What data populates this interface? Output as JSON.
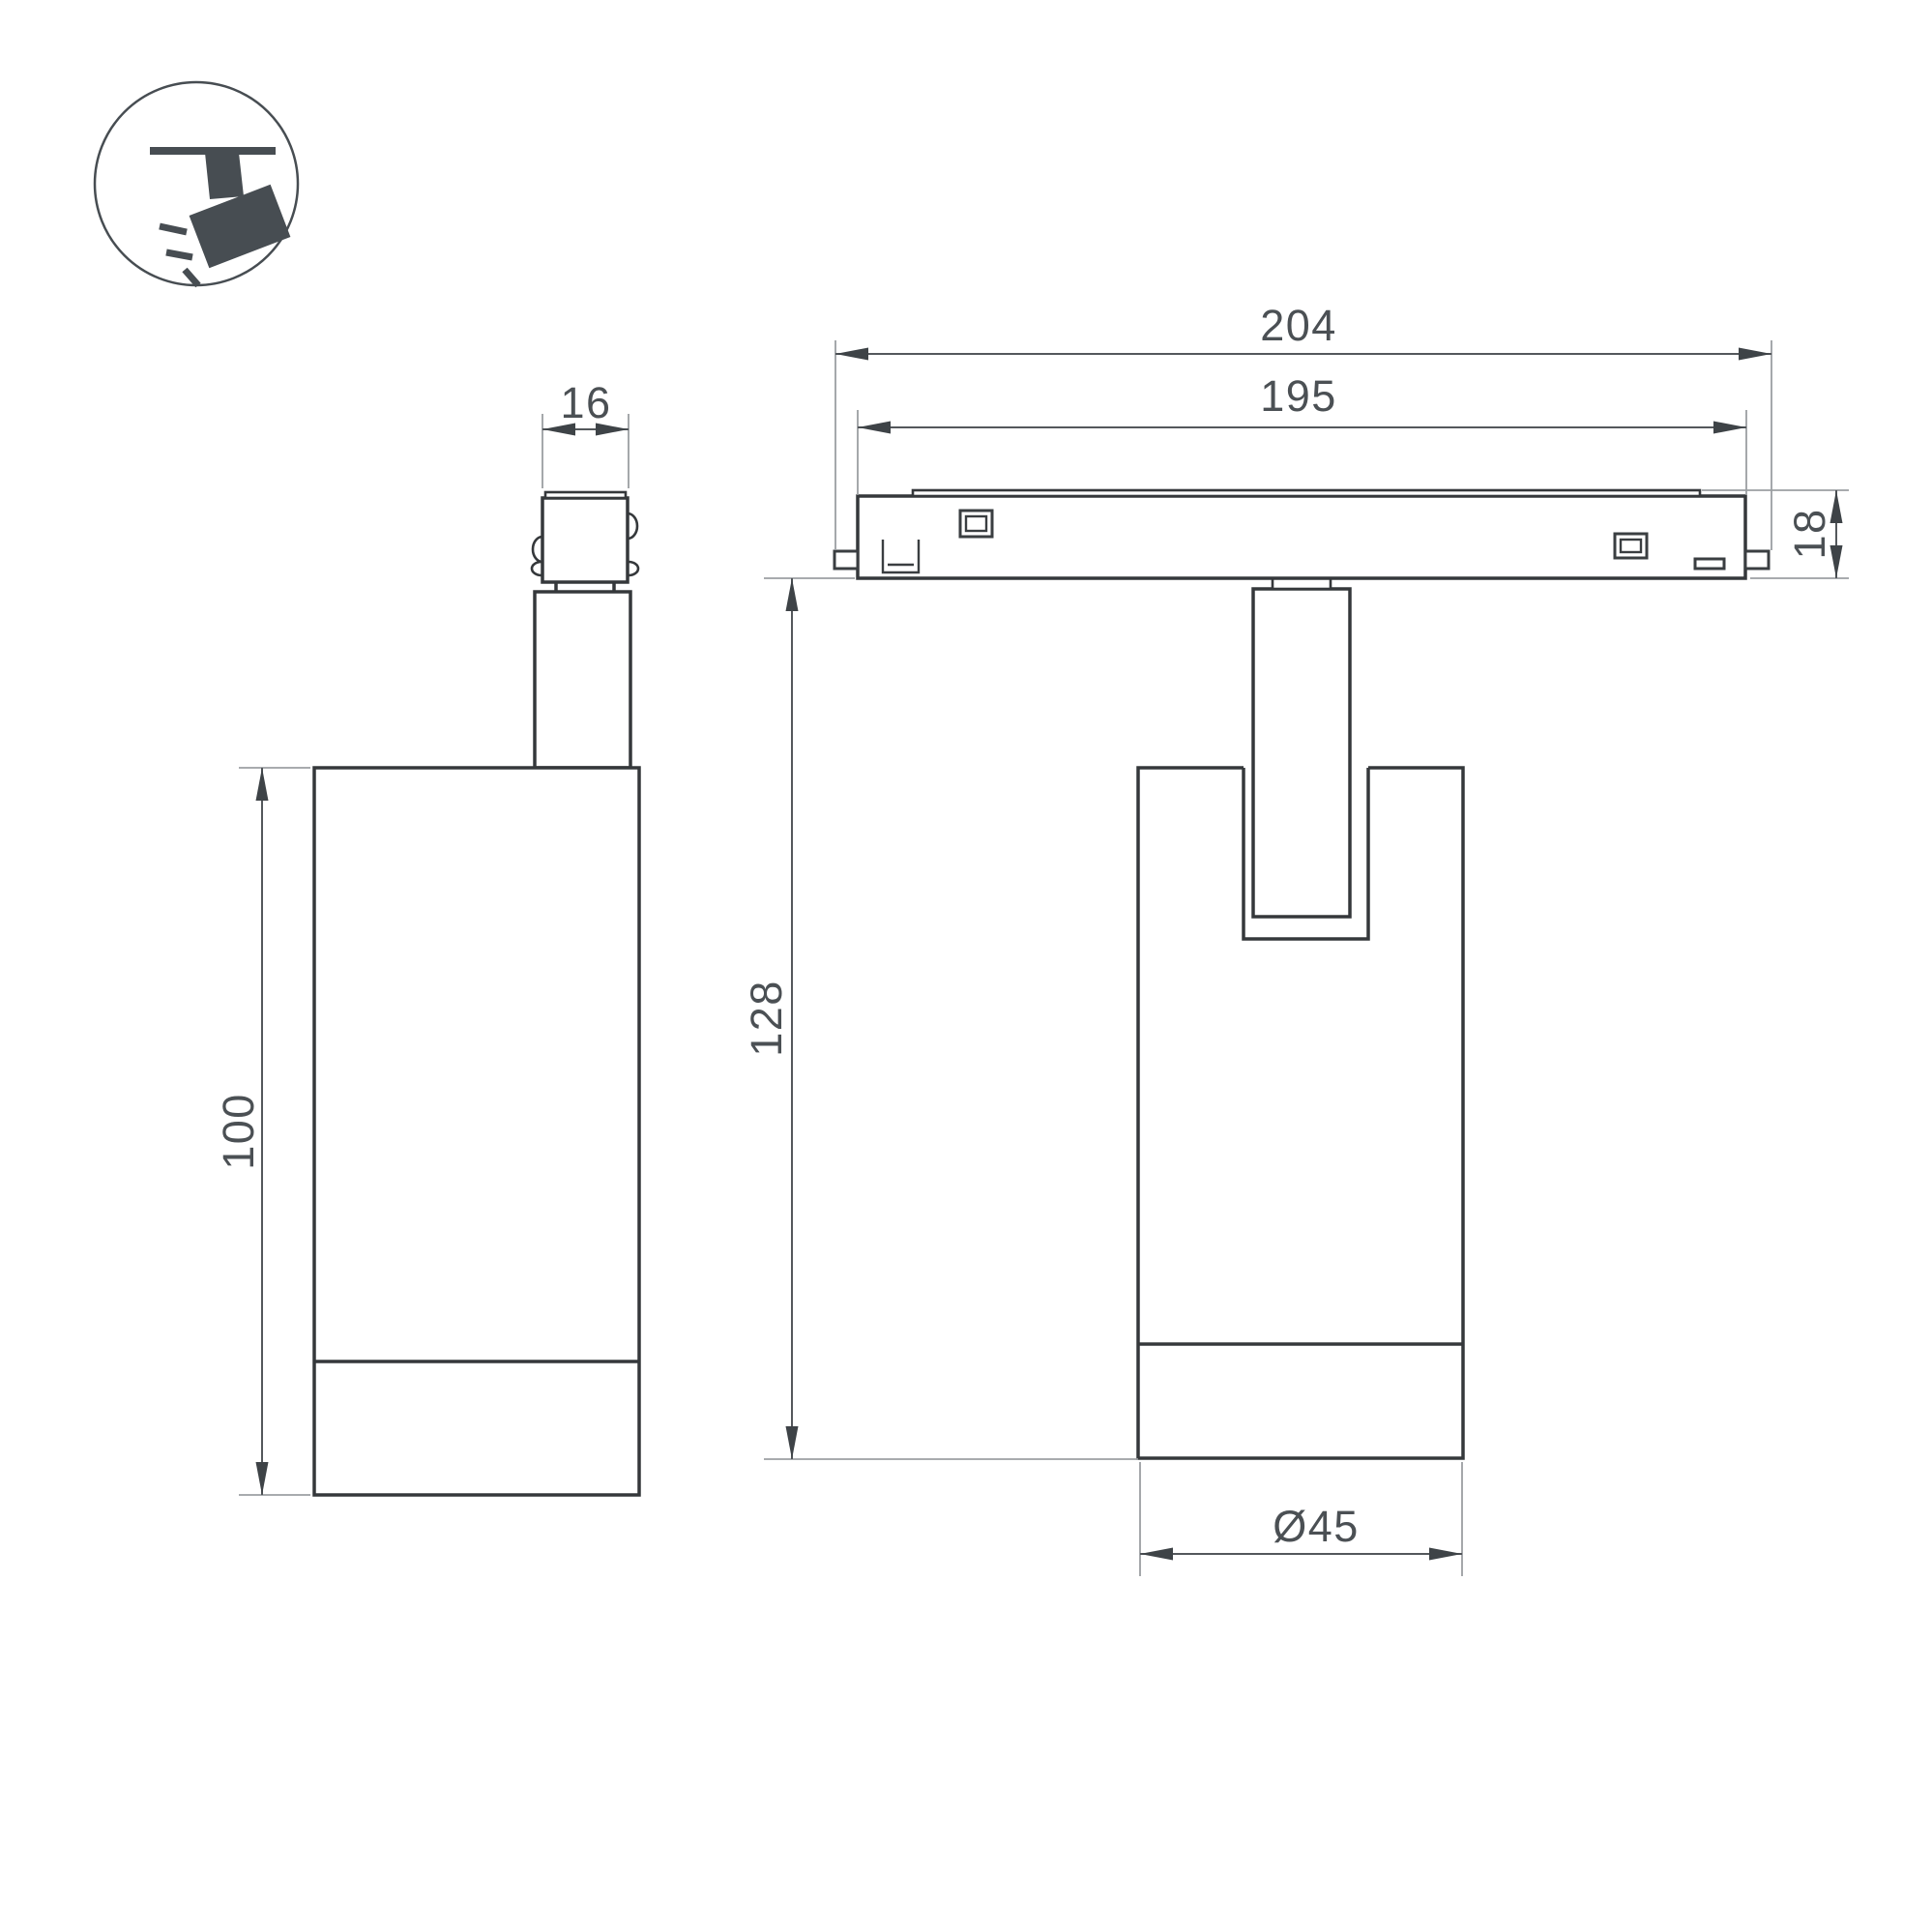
{
  "title": "Track spotlight dimension drawing",
  "colors": {
    "background": "#ffffff",
    "object_line": "#35383b",
    "dimension_line": "#54585c",
    "extension_line": "#9b9fa2",
    "text": "#4b5054",
    "icon": "#474d52"
  },
  "icon": {
    "label": "track-spotlight"
  },
  "side_view": {
    "adapter_width_mm": "16",
    "body_height_mm": "100"
  },
  "front_view": {
    "track_length_mm": "204",
    "track_window_mm": "195",
    "track_height_mm": "18",
    "overall_height_mm": "128",
    "body_diameter_mm": "Ø45"
  }
}
